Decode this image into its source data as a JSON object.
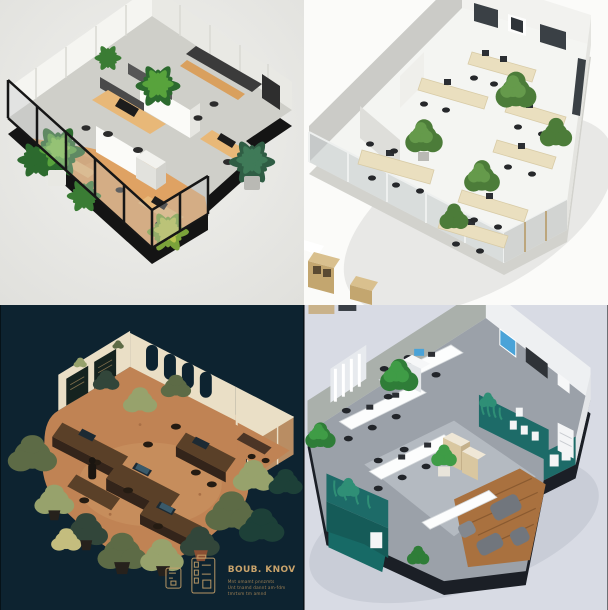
{
  "artwork": {
    "kind": "2x2 grid of AI-generated isometric office interior concept renders",
    "subject": "office floor plans filled with desks, computers and indoor plants",
    "panels_count": 4
  },
  "panels": [
    {
      "id": "top-left",
      "description": "photoreal 3D cutaway office with black-framed glass balcony walls, wood floors and tropical palms",
      "palette": {
        "background": "#e9e9e6",
        "floor": "#cfcfc9",
        "wood": "#dfa263",
        "walls": "#f5f5f1",
        "frames": "#161616",
        "partition": "#4a4a4a",
        "foliage_dark": "#2c6a2e",
        "foliage_light": "#58a33c",
        "foliage_teal": "#2f5d44",
        "foliage_yellow": "#b9c44f"
      }
    },
    {
      "id": "top-right",
      "description": "clean white 3D render of an open-plan office with rows of beige desks, black chairs and indoor trees",
      "palette": {
        "background": "#fbfbf9",
        "floor": "#f4f5f2",
        "walls_gray": "#cbcbc7",
        "walls_white": "#f2f2ef",
        "desks": "#eadfbf",
        "glass": "#c3c8ca",
        "chairs": "#26282b",
        "foliage": "#4c7c39",
        "window": "#3a4045"
      }
    },
    {
      "id": "bottom-left",
      "description": "flat-illustration dark botanical office cafe with chunky brown desks, terracotta floor and dense plants",
      "palette": {
        "background": "#0d2330",
        "walls": "#eadfc6",
        "floor": "#c08354",
        "furniture": "#4c3526",
        "furniture_front": "#33241a",
        "foliage_olive": "#5d6b46",
        "foliage_sage": "#97a26c",
        "foliage_dark": "#32463a",
        "foliage_pale": "#c4bd7e",
        "accent_text": "#c9a36b",
        "screen": "#3a5a6a"
      },
      "caption": {
        "heading": "BOUB. KNOV",
        "subtext_illegible": [
          "Mnt omamt pnnzmts",
          "Unt tnamd dannt am-fdm",
          "tmrtxm tm amnd"
        ],
        "icons": [
          "mini-floorplan-icon",
          "floorplan-sheet-icon"
        ]
      }
    },
    {
      "id": "bottom-right",
      "description": "3D render of a white office with teal accent walls, hanging plants, wood-floor lounge and gray sofas",
      "palette": {
        "background": "#d8dbe4",
        "walls_gray": "#aab0ab",
        "walls_white": "#eef0f2",
        "accent_teal": "#1d6b68",
        "floor": "#9ba1a9",
        "wood_floor": "#a9713f",
        "sofas": "#71767d",
        "cabinets": "#d9c7a0",
        "foliage": "#3f9c46",
        "foliage_teal": "#2f8f76",
        "poster_blue": "#4aa3d8",
        "plinth": "#1b1f26"
      }
    }
  ]
}
